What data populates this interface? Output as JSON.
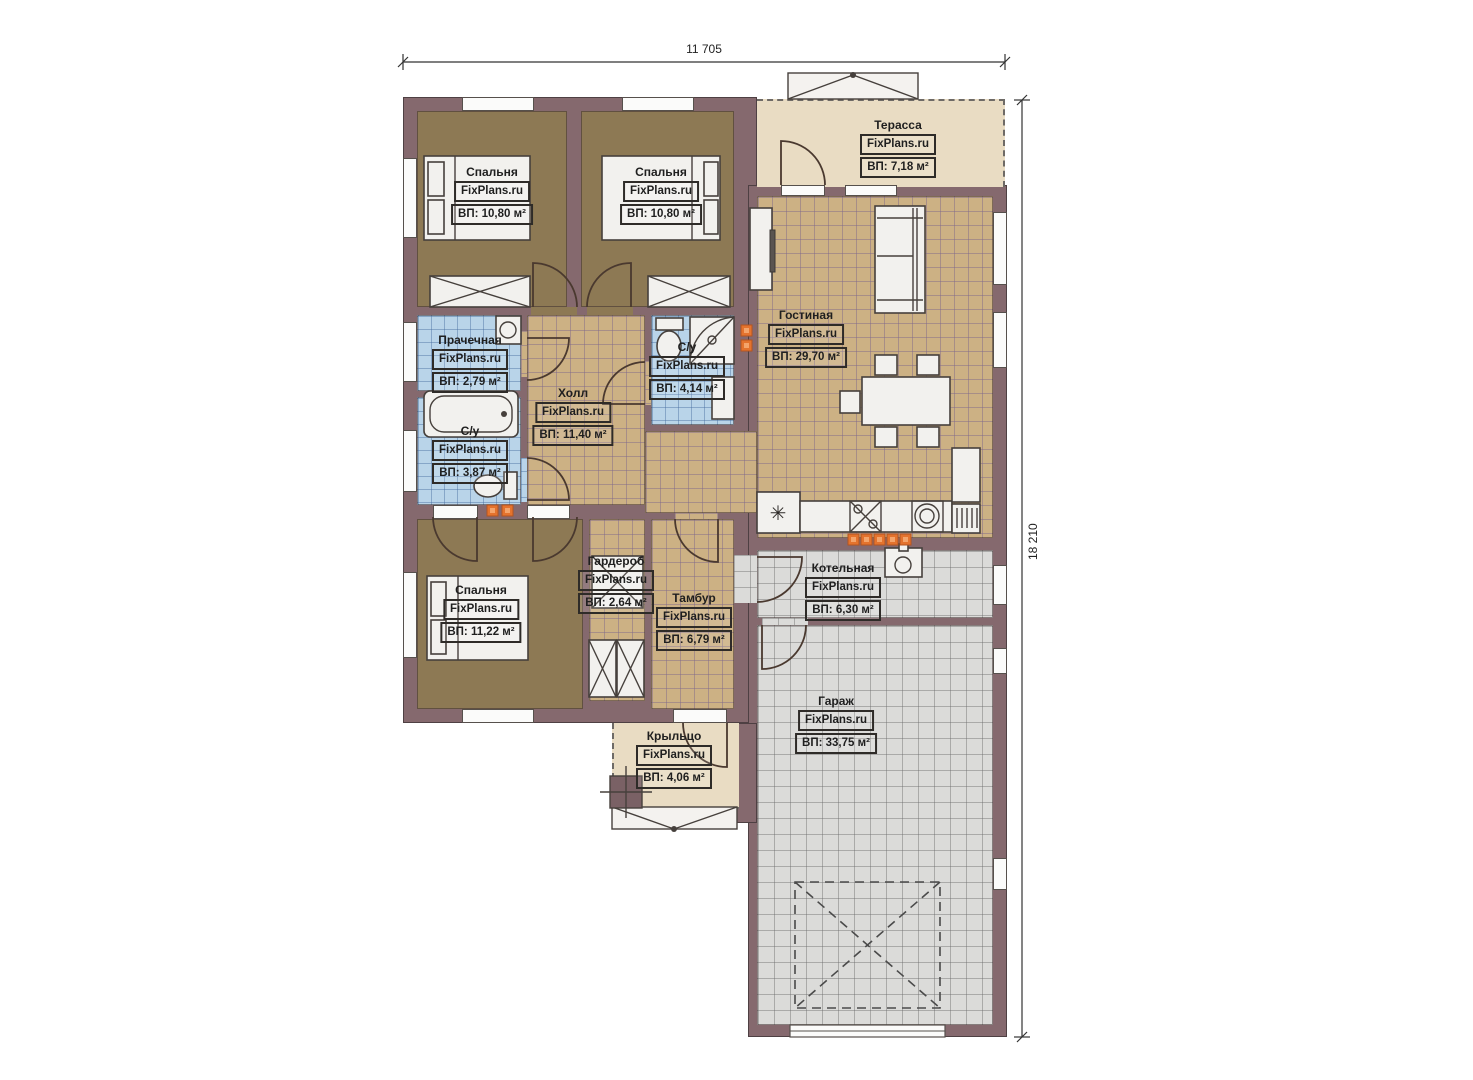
{
  "plan": {
    "title": "Одноэтажный дом — план этажа",
    "watermark": "FixPlans.ru",
    "dimensions": {
      "width_label": "11 705",
      "height_label": "18 210"
    },
    "rooms": [
      {
        "name": "Спальня",
        "area": "ВП: 10,80 м²"
      },
      {
        "name": "Спальня",
        "area": "ВП: 10,80 м²"
      },
      {
        "name": "Терасса",
        "area": "ВП: 7,18 м²"
      },
      {
        "name": "Гостиная",
        "area": "ВП: 29,70 м²"
      },
      {
        "name": "Прачечная",
        "area": "ВП: 2,79 м²"
      },
      {
        "name": "С/у",
        "area": "ВП: 4,14 м²"
      },
      {
        "name": "Холл",
        "area": "ВП: 11,40 м²"
      },
      {
        "name": "С/у",
        "area": "ВП: 3,87 м²"
      },
      {
        "name": "Спальня",
        "area": "ВП: 11,22 м²"
      },
      {
        "name": "Гардероб",
        "area": "ВП: 2,64 м²"
      },
      {
        "name": "Тамбур",
        "area": "ВП: 6,79 м²"
      },
      {
        "name": "Котельная",
        "area": "ВП: 6,30 м²"
      },
      {
        "name": "Гараж",
        "area": "ВП: 33,75 м²"
      },
      {
        "name": "Крыльцо",
        "area": "ВП: 4,06 м²"
      }
    ],
    "icons": {
      "freezer_symbol": "✳"
    },
    "colors": {
      "wall": "#85696e",
      "bedroom_floor": "#8d7954",
      "tile_tan": "#ccb184",
      "tile_blue": "#b9d4e9",
      "tile_gray": "#dbdbd9",
      "terrace_beige": "#e9dcc3",
      "heat_marker": "#e4732e"
    }
  }
}
